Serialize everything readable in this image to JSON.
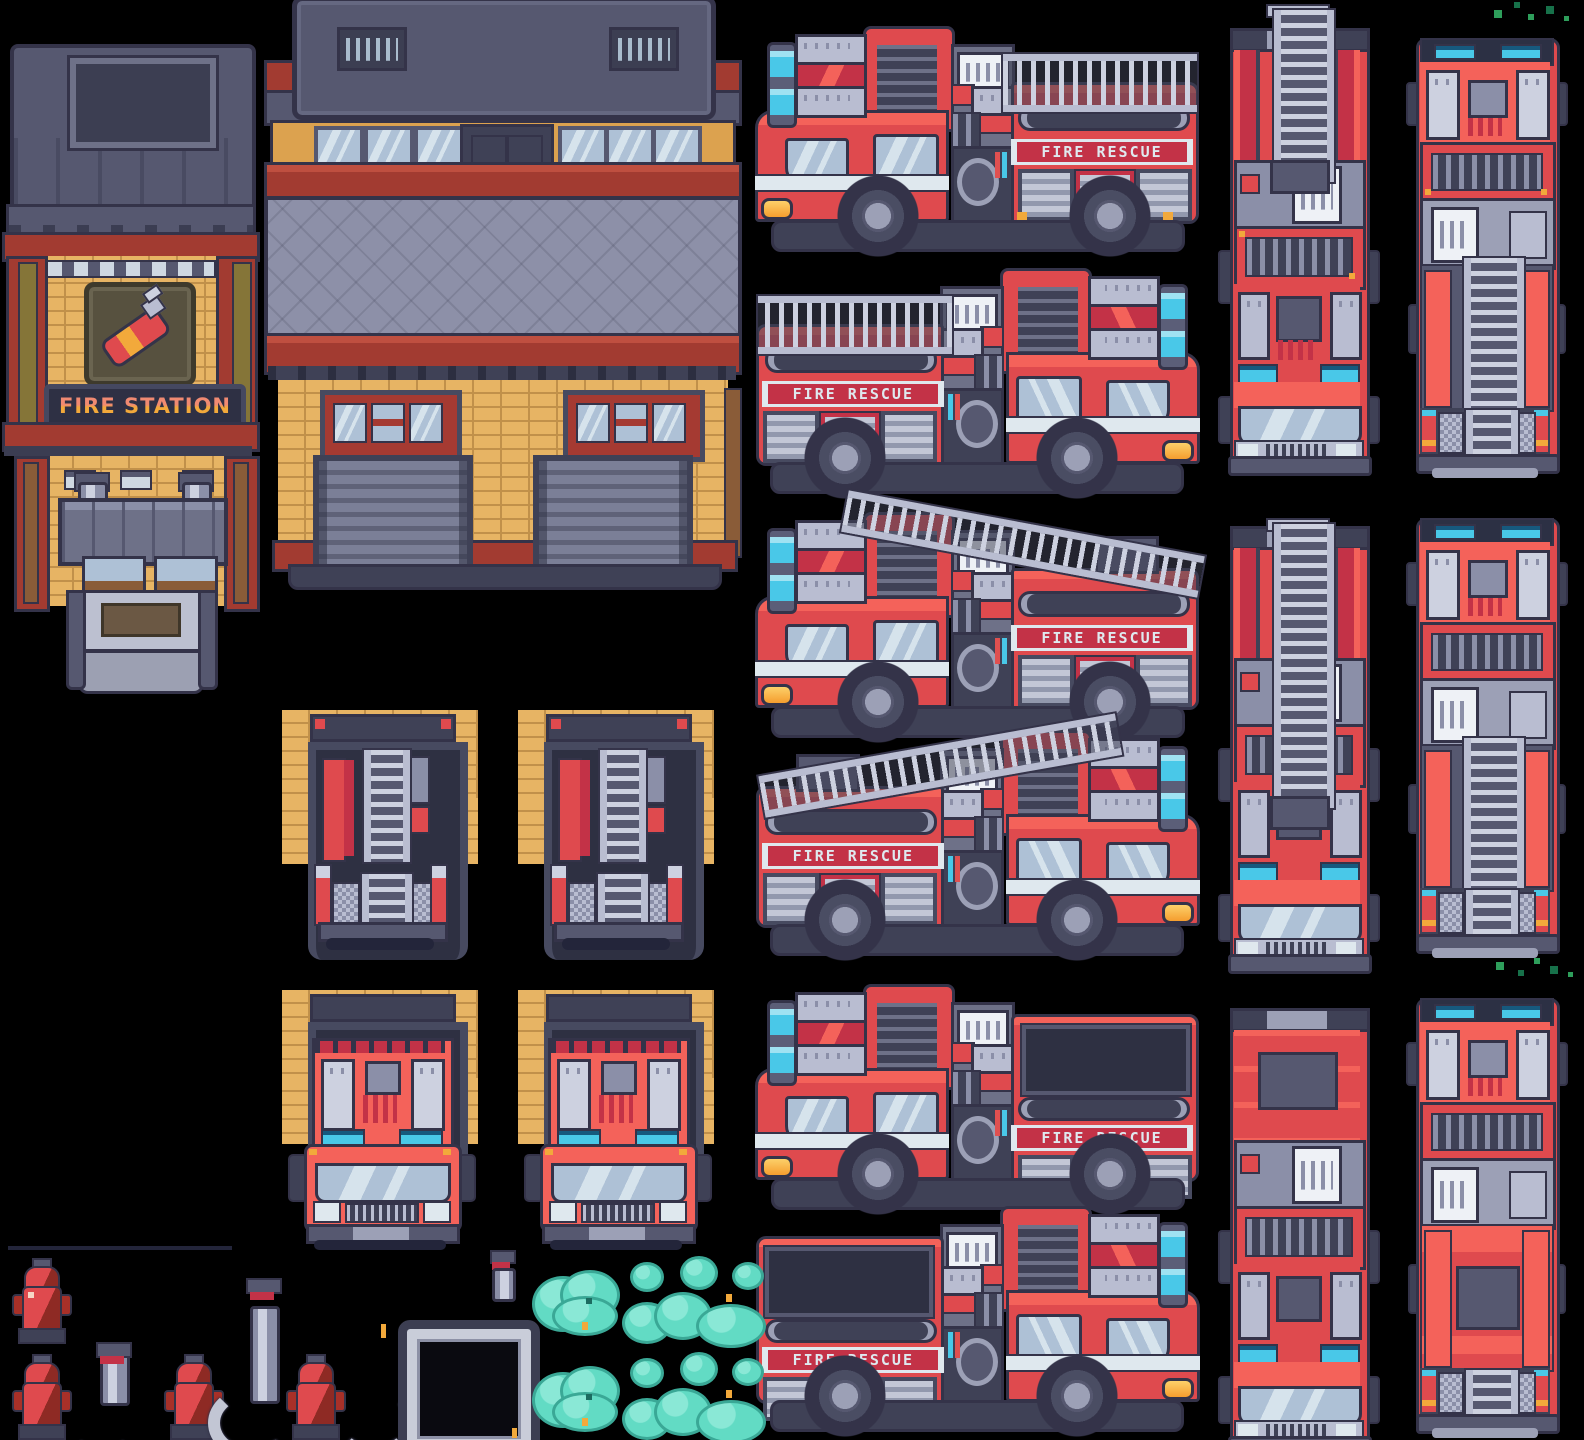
{
  "canvas": {
    "width": 1584,
    "height": 1440
  },
  "fire_station": {
    "sign_text": "FIRE STATION"
  },
  "trucks": {
    "livery_text": "FIRE RESCUE"
  },
  "palette": {
    "bg": "#000000",
    "outline": "#343349",
    "chassis": "#3f4156",
    "roof_dark": "#565870",
    "slate": "#5b5e78",
    "slate_light": "#8b8fa8",
    "silver": "#b9bdd1",
    "silver_bright": "#cdd1e0",
    "white": "#dfe8ee",
    "red_bright": "#f4625a",
    "red": "#df4a4e",
    "red_dark": "#c33247",
    "trim_red": "#a23b31",
    "trim_dark": "#7c2b24",
    "window": "#aec1d6",
    "window_hi": "#d6e3ec",
    "cyan": "#49c8e8",
    "amber": "#f2a93b",
    "brick": "#e7b464",
    "brick_line": "#c1904a",
    "wood": "#8a5c38",
    "wood_olive": "#857538",
    "roof": "#8d90a8",
    "sign_bg": "#2e3044",
    "sign_frame": "#454860",
    "letter_top": "#f08a72",
    "letter_bot": "#f2a93b",
    "teal": "#62dbc4",
    "teal_hi": "#8ae8d6",
    "teal_dark": "#3aa896",
    "green1": "#2e9e5b",
    "green2": "#17714a"
  },
  "inventory": {
    "buildings": [
      "fire-station-tower",
      "fire-station-garage-building"
    ],
    "side_trucks": [
      "ladder-truck-side-left",
      "ladder-truck-side-right",
      "ladder-truck-side-left-raised",
      "ladder-truck-side-right-raised",
      "truck-side-left-open-bed",
      "truck-side-right-open-bed"
    ],
    "top_trucks": [
      "ladder-truck-top-extended-facing-down",
      "ladder-truck-top-extended-facing-up",
      "ladder-truck-top-stowed-facing-down",
      "ladder-truck-top-stowed-facing-up",
      "truck-top-plain-facing-down",
      "truck-top-plain-facing-up"
    ],
    "doorways": [
      "doorway-truck-rear-a",
      "doorway-truck-rear-b",
      "doorway-truck-front-a",
      "doorway-truck-front-b"
    ],
    "props": [
      "fire-hydrant",
      "fire-hydrant-hose-short",
      "fire-hydrant-hose-tall",
      "fire-hydrant-hose-long",
      "hose-nozzle",
      "hose-frame",
      "water-splash-big",
      "water-splash-trio",
      "water-splash-cluster",
      "grass-specks"
    ]
  }
}
